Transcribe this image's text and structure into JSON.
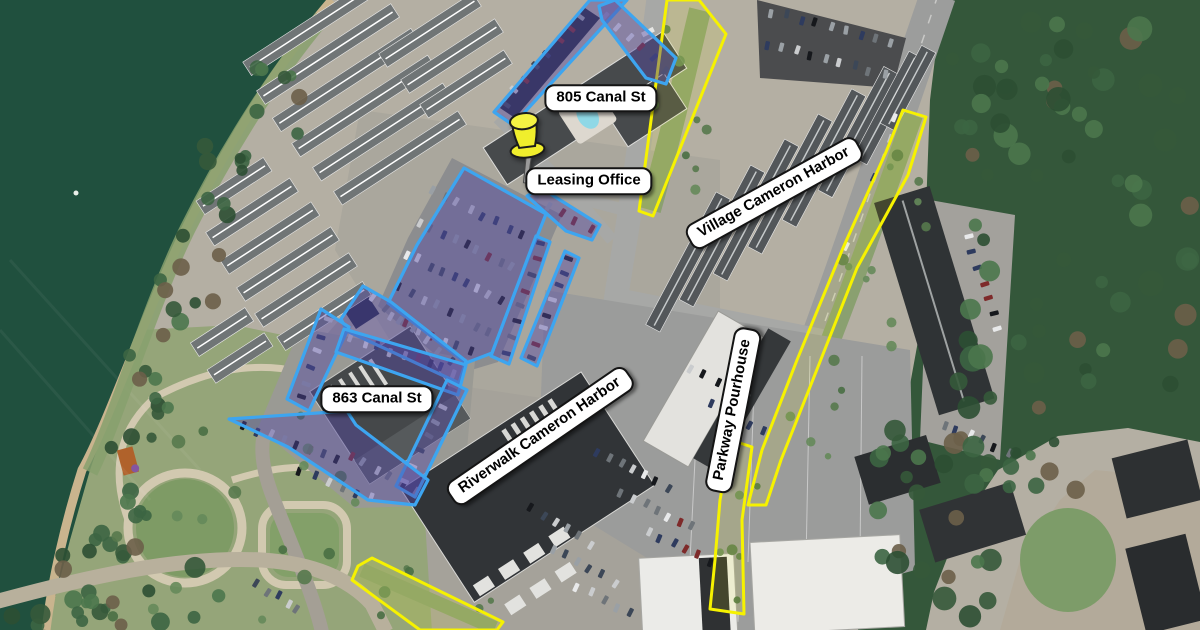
{
  "map": {
    "type": "aerial-satellite-with-annotations",
    "area": "Cameron Harbor riverfront district",
    "colors": {
      "region_outline_blue": "#3da5f0",
      "region_fill_purple": "rgba(84,74,165,0.45)",
      "boundary_yellow": "#f6f200",
      "boundary_yellow_fill": "rgba(255,252,0,0.10)",
      "label_background": "#ffffff",
      "label_border": "#141414",
      "label_text": "#000000",
      "pin_yellow": "#f0ee2c",
      "water_green": "#20503e",
      "forest_green": "#34573a"
    },
    "labels": [
      {
        "id": "805-canal-st",
        "text": "805 Canal St",
        "x": 601,
        "y": 98,
        "rotation": 0
      },
      {
        "id": "leasing-office",
        "text": "Leasing Office",
        "x": 589,
        "y": 181,
        "rotation": 0
      },
      {
        "id": "863-canal-st",
        "text": "863 Canal St",
        "x": 377,
        "y": 399,
        "rotation": 0
      },
      {
        "id": "village-cameron-harbor",
        "text": "Village Cameron Harbor",
        "x": 774,
        "y": 193,
        "rotation": -29
      },
      {
        "id": "riverwalk-cameron-harbor",
        "text": "Riverwalk Cameron Harbor",
        "x": 540,
        "y": 436,
        "rotation": -34.5
      },
      {
        "id": "parkway-pourhouse",
        "text": "Parkway Pourhouse",
        "x": 733,
        "y": 410,
        "rotation": -79
      }
    ],
    "pin": {
      "id": "leasing-office-pin",
      "x": 527,
      "y": 150
    },
    "highlighted_parcels_blue": [
      {
        "id": "canal805-north-strip",
        "points": [
          [
            494,
            112
          ],
          [
            590,
            0
          ],
          [
            627,
            0
          ],
          [
            513,
            125
          ]
        ]
      },
      {
        "id": "canal805-east-strip",
        "points": [
          [
            599,
            6
          ],
          [
            615,
            0
          ],
          [
            676,
            58
          ],
          [
            666,
            84
          ],
          [
            646,
            78
          ],
          [
            602,
            20
          ]
        ]
      },
      {
        "id": "leasing-office-strip",
        "points": [
          [
            527,
            196
          ],
          [
            541,
            188
          ],
          [
            600,
            225
          ],
          [
            592,
            240
          ],
          [
            566,
            231
          ]
        ]
      },
      {
        "id": "central-parking-main",
        "points": [
          [
            464,
            168
          ],
          [
            546,
            214
          ],
          [
            517,
            287
          ],
          [
            492,
            353
          ],
          [
            466,
            363
          ],
          [
            388,
            303
          ],
          [
            417,
            245
          ]
        ]
      },
      {
        "id": "central-parking-row-east1",
        "points": [
          [
            536,
            236
          ],
          [
            550,
            242
          ],
          [
            509,
            364
          ],
          [
            491,
            356
          ]
        ]
      },
      {
        "id": "central-parking-row-east2",
        "points": [
          [
            565,
            251
          ],
          [
            579,
            258
          ],
          [
            537,
            366
          ],
          [
            521,
            358
          ]
        ]
      },
      {
        "id": "central-parking-sw-band",
        "points": [
          [
            363,
            286
          ],
          [
            391,
            302
          ],
          [
            466,
            361
          ],
          [
            459,
            383
          ],
          [
            347,
            331
          ],
          [
            341,
            319
          ]
        ]
      },
      {
        "id": "canal863-west-strip",
        "points": [
          [
            321,
            309
          ],
          [
            349,
            327
          ],
          [
            309,
            411
          ],
          [
            287,
            399
          ]
        ]
      },
      {
        "id": "canal863-north-lot",
        "points": [
          [
            344,
            329
          ],
          [
            466,
            365
          ],
          [
            458,
            395
          ],
          [
            336,
            352
          ]
        ]
      },
      {
        "id": "canal863-east-strip",
        "points": [
          [
            447,
            380
          ],
          [
            467,
            390
          ],
          [
            415,
            497
          ],
          [
            396,
            486
          ]
        ]
      },
      {
        "id": "canal863-south-lot",
        "points": [
          [
            229,
            419
          ],
          [
            347,
            411
          ],
          [
            356,
            425
          ],
          [
            428,
            480
          ],
          [
            415,
            505
          ],
          [
            368,
            500
          ],
          [
            288,
            447
          ]
        ]
      }
    ],
    "boundary_strips_yellow": [
      {
        "id": "canal-street-verge",
        "points": [
          [
            667,
            0
          ],
          [
            699,
            0
          ],
          [
            726,
            34
          ],
          [
            653,
            216
          ],
          [
            639,
            211
          ]
        ]
      },
      {
        "id": "parkway-verge-north",
        "points": [
          [
            903,
            110
          ],
          [
            926,
            117
          ],
          [
            908,
            175
          ],
          [
            857,
            268
          ],
          [
            812,
            382
          ],
          [
            781,
            460
          ],
          [
            766,
            505
          ],
          [
            748,
            505
          ],
          [
            762,
            450
          ],
          [
            797,
            360
          ],
          [
            843,
            248
          ],
          [
            886,
            152
          ]
        ]
      },
      {
        "id": "parkway-verge-south",
        "points": [
          [
            737,
            442
          ],
          [
            752,
            447
          ],
          [
            742,
            520
          ],
          [
            744,
            614
          ],
          [
            710,
            609
          ],
          [
            715,
            560
          ],
          [
            720,
            500
          ],
          [
            727,
            462
          ]
        ]
      },
      {
        "id": "broad-street-verge",
        "points": [
          [
            358,
            566
          ],
          [
            372,
            558
          ],
          [
            503,
            622
          ],
          [
            497,
            630
          ],
          [
            420,
            630
          ],
          [
            352,
            580
          ]
        ]
      }
    ]
  }
}
